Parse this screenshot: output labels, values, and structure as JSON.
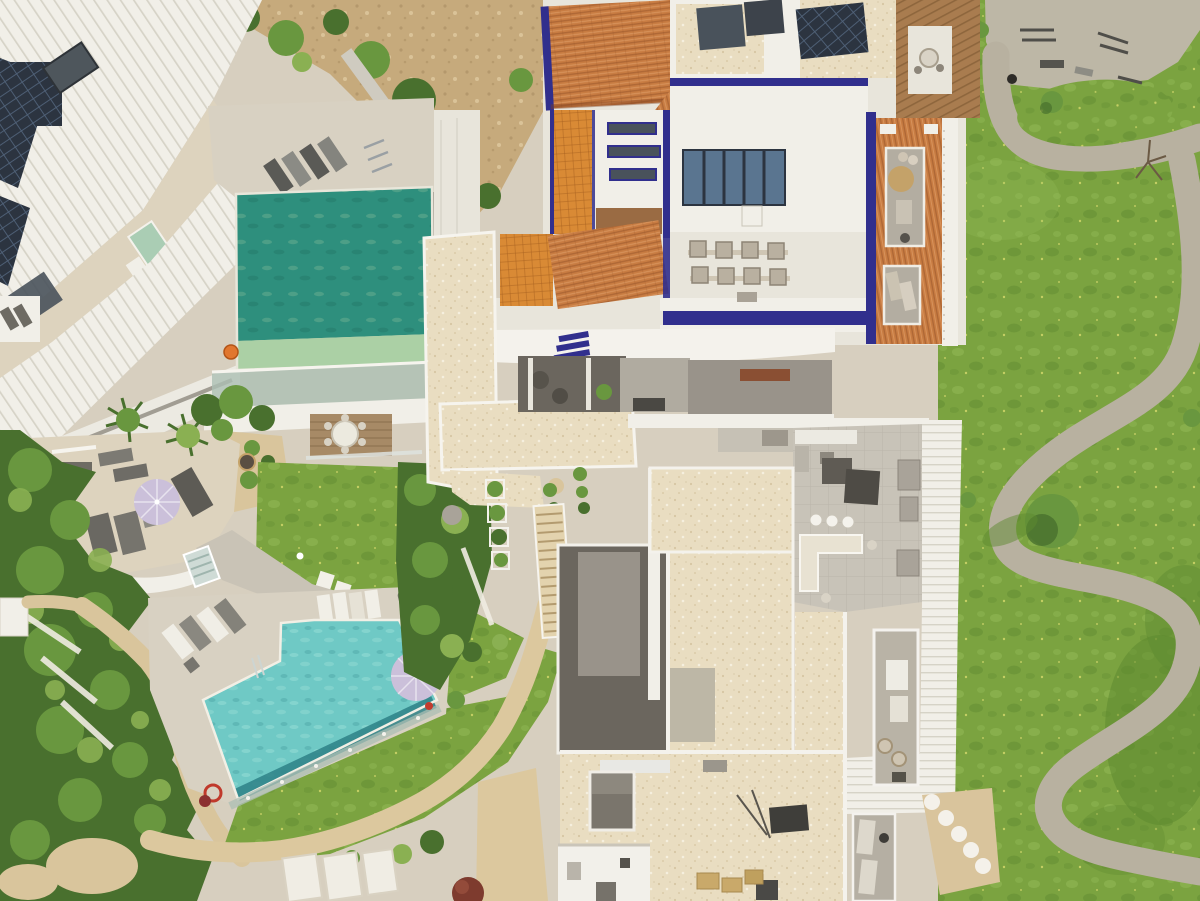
{
  "scene": {
    "title": "Aerial view of a residential resort complex",
    "description": "Top-down drone photograph of a luxury residential community: a white modern villa with rooftop solar panels and an emerald infinity pool at top left, a Mediterranean building with terracotta tile roofs, indigo-blue trim, rooftop solar array and seating at top center, a large turquoise community pool with sun loungers and a lavender parasol at bottom left surrounded by dense gardens and sandy paths, modern white apartment blocks with cream gravel rooftops, roof terraces and balconies in the center and bottom right, and wide green lawns with winding gray concrete paths and an outdoor fitness area on the right."
  },
  "colors": {
    "stone": "#d7cfbf",
    "white": "#f1efe8",
    "white2": "#e8e5db",
    "rib": "#d6d3c7",
    "cream": "#e9ddc1",
    "speckD": "#c3ad85",
    "speckL": "#f7f1e2",
    "paver": "#c8c3b8",
    "grass": "#7ba340",
    "grassL": "#98c05a",
    "grassD": "#5e8a30",
    "dandelion": "#d6da6c",
    "path": "#b8b1a0",
    "pad": "#bdb7a6",
    "sand": "#d9c59c",
    "slope": "#c6aa7c",
    "slopeD": "#a017",
    "terr": "#c87c42",
    "terrD": "#96542a",
    "terrL": "#e5a873",
    "orange": "#d98a35",
    "orangeD": "#a65f1e",
    "indigo": "#312f8d",
    "solar": "#2c3440",
    "solarL": "#51637a",
    "panel": "#5a7590",
    "slate": "#49525b",
    "em": "#2e8f7d",
    "emL": "#abd0a5",
    "tq": "#6fc9c5",
    "tqL": "#9adfd8",
    "tqD": "#2e8287",
    "glass": "#adbfb4",
    "lavender": "#cbc0da",
    "mint": "#aacdb4",
    "wood": "#a97c4f",
    "woodD": "#7c5631",
    "veg1": "#49702e",
    "veg2": "#69973f",
    "veg3": "#8ab052",
    "grayF": "#6e6b63",
    "charcoal": "#5b5750",
    "deck": "#d8d1c2",
    "terrace": "#ddd3be",
    "dgray": "#6b665e",
    "mgray": "#99938a",
    "tan": "#c4a269"
  },
  "features": [
    {
      "name": "white-villa",
      "label": "Modern white villa with ribbed roof and solar panels"
    },
    {
      "name": "emerald-pool",
      "label": "Emerald green infinity pool with glass balustrade"
    },
    {
      "name": "mediterranean-building",
      "label": "Terracotta-roofed building with indigo blue trim"
    },
    {
      "name": "rooftop-solar-array",
      "label": "Rooftop solar panel array"
    },
    {
      "name": "rooftop-seating",
      "label": "Rooftop seating cubes"
    },
    {
      "name": "pergola",
      "label": "Wooden pergola with patio table"
    },
    {
      "name": "community-lawn",
      "label": "Large community lawn with dandelions"
    },
    {
      "name": "fitness-area",
      "label": "Outdoor fitness concrete pad with equipment"
    },
    {
      "name": "winding-path",
      "label": "Winding gray concrete footpaths"
    },
    {
      "name": "garden-terrace",
      "label": "Private terrace with lavender parasol and loungers"
    },
    {
      "name": "palm-garden",
      "label": "Palm trees and dense garden vegetation"
    },
    {
      "name": "turquoise-pool",
      "label": "Turquoise community pool with glass fence"
    },
    {
      "name": "sun-loungers",
      "label": "Rows of sun loungers"
    },
    {
      "name": "walkway-bridge",
      "label": "Cream stone elevated walkway and staircase"
    },
    {
      "name": "penthouse-terrace",
      "label": "Roof terrace with outdoor kitchen and furniture"
    },
    {
      "name": "lower-rooftops",
      "label": "Cream gravel rooftops with skylight and AC units"
    },
    {
      "name": "sandy-paths",
      "label": "Sandy garden paths"
    },
    {
      "name": "hillside-garden",
      "label": "Rocky hillside with olive trees"
    }
  ]
}
